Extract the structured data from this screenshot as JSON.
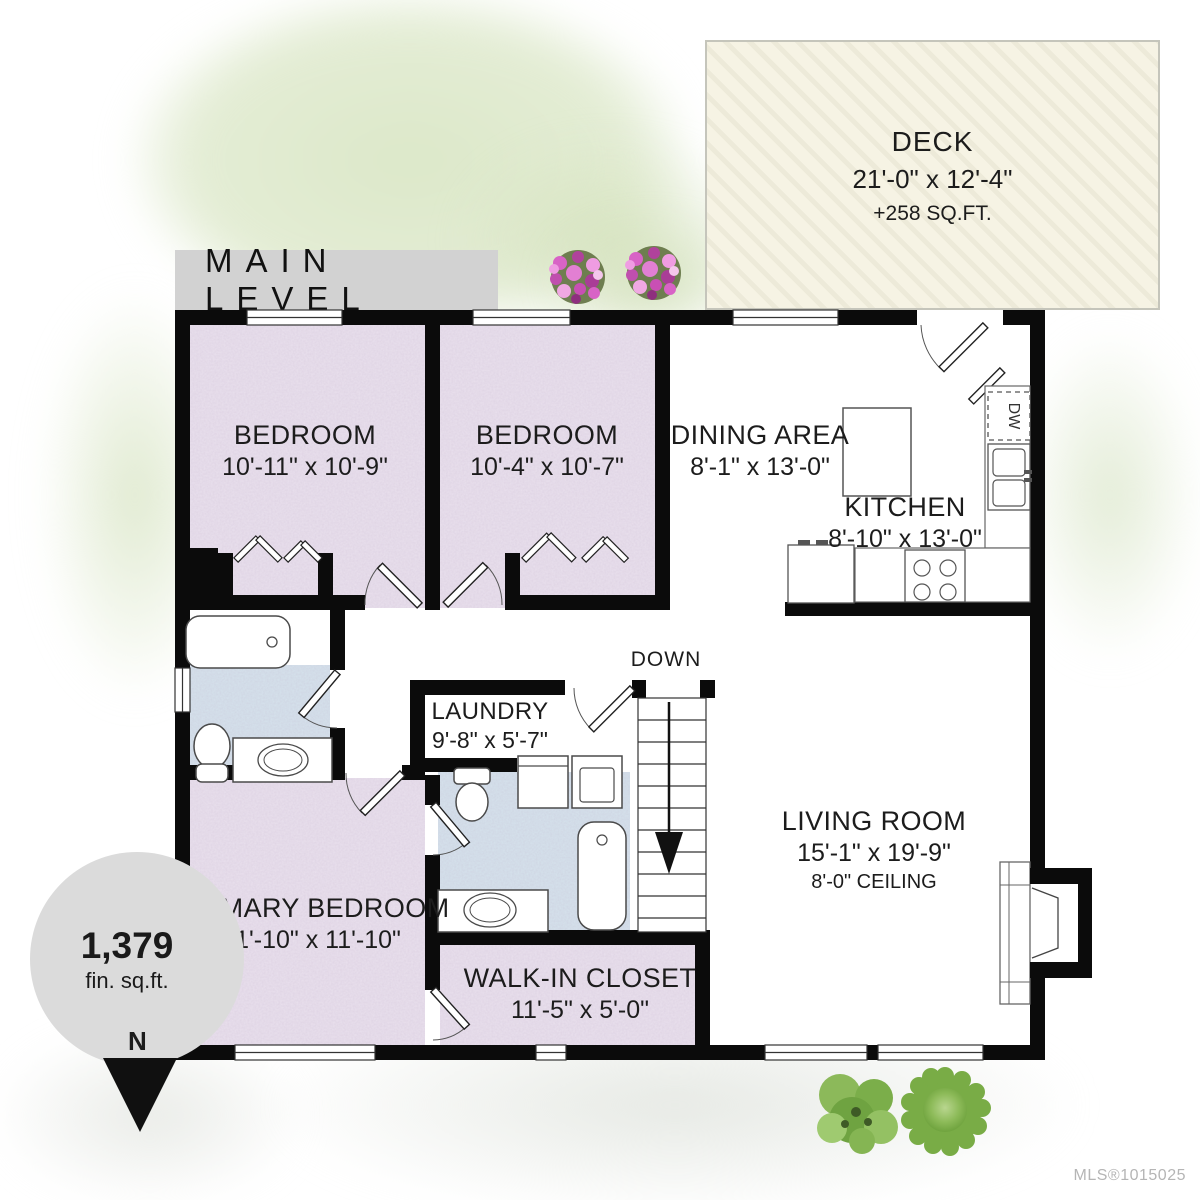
{
  "title": {
    "label": "MAIN LEVEL"
  },
  "deck": {
    "name": "DECK",
    "dims": "21'-0\" x 12'-4\"",
    "area": "+258 SQ.FT."
  },
  "rooms": {
    "bedroom1": {
      "name": "BEDROOM",
      "dims": "10'-11\" x 10'-9\""
    },
    "bedroom2": {
      "name": "BEDROOM",
      "dims": "10'-4\" x 10'-7\""
    },
    "dining": {
      "name": "DINING AREA",
      "dims": "8'-1\" x 13'-0\""
    },
    "kitchen": {
      "name": "KITCHEN",
      "dims": "8'-10\" x 13'-0\""
    },
    "laundry": {
      "name": "LAUNDRY",
      "dims": "9'-8\" x 5'-7\""
    },
    "living": {
      "name": "LIVING ROOM",
      "dims": "15'-1\" x 19'-9\"",
      "ceiling": "8'-0\" CEILING"
    },
    "primary": {
      "name": "PRIMARY BEDROOM",
      "dims": "11'-10\" x 11'-10\""
    },
    "walkin": {
      "name": "WALK-IN CLOSET",
      "dims": "11'-5\" x 5'-0\""
    }
  },
  "stairs": {
    "label": "DOWN"
  },
  "kitchen_appliances": {
    "dishwasher": "DW"
  },
  "area_badge": {
    "value": "1,379",
    "unit": "fin. sq.ft."
  },
  "compass": {
    "label": "N"
  },
  "credit": {
    "mls": "MLS®1015025"
  },
  "colors": {
    "wall": "#0b0b0b",
    "bedroom_fill": "#eae1ee",
    "bathroom_fill": "#d6e3ed",
    "deck_fill": "#f6f3e4",
    "banner_bg": "#d2d2d2",
    "badge_bg": "#dbdbdb",
    "watercolor_green": "#dce8c9",
    "tree_green": "#79ac46",
    "flower_pink": "#d863c6",
    "mls_text": "#b5b5b5"
  }
}
